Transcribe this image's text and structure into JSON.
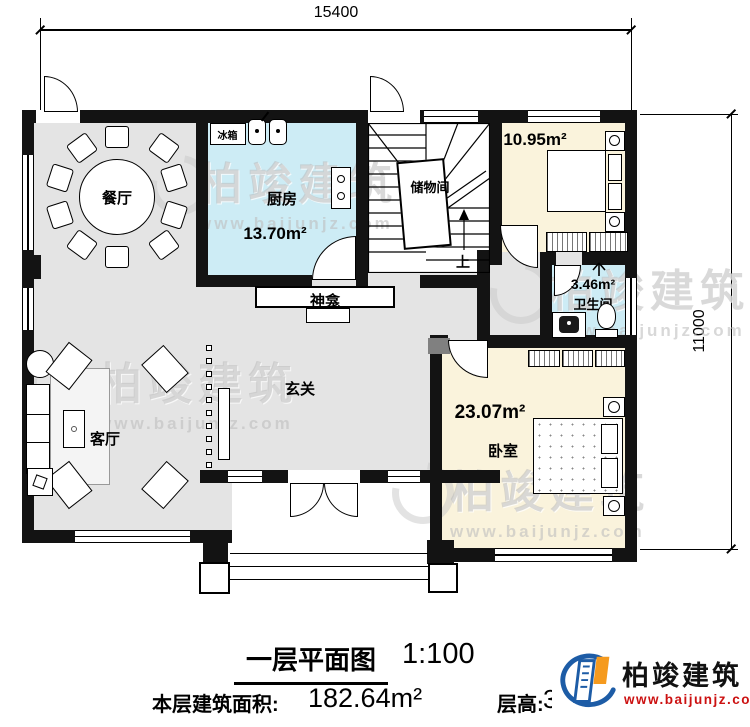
{
  "dims": {
    "top": "15400",
    "right": "11000"
  },
  "rooms": {
    "dining": {
      "label": "餐厅"
    },
    "kitchen": {
      "label": "厨房",
      "area": "13.70m²"
    },
    "fridge": {
      "label": "冰箱"
    },
    "storage": {
      "label": "储物间"
    },
    "stairs": {
      "up": "上"
    },
    "guest": {
      "label": "客房",
      "area": "10.95m²"
    },
    "bath": {
      "label": "卫生间",
      "area": "3.46m²"
    },
    "shrine": {
      "label": "神龛"
    },
    "foyer": {
      "label": "玄关"
    },
    "living": {
      "label": "客厅"
    },
    "bedroom": {
      "label": "卧室",
      "area": "23.07m²"
    }
  },
  "title_block": {
    "title": "一层平面图",
    "scale": "1:100",
    "area_label": "本层建筑面积:",
    "area_value": "182.64m²",
    "height_label": "层高:",
    "height_value": "3.6m"
  },
  "branding": {
    "company": "柏竣建筑",
    "website": "www.baijunjz.com"
  },
  "colors": {
    "floor_gray": "#e4e4e4",
    "wet_blue": "#cdecf5",
    "warm_cream": "#faf3dc",
    "wall_black": "#131313",
    "logo_blue": "#1d5ca6",
    "logo_orange": "#f59a1e",
    "website_red": "#cc1111",
    "watermark_gray": "#c8c8c8"
  }
}
